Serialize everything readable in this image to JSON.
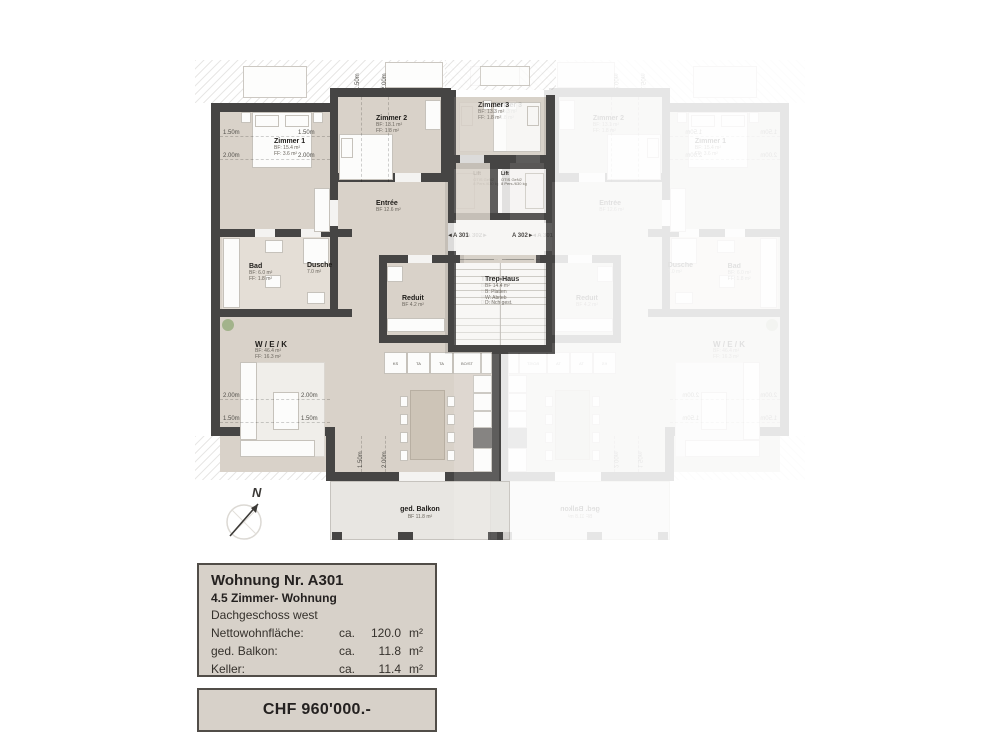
{
  "plan": {
    "compass_label": "N",
    "dims": {
      "d150": "1.50m",
      "d200": "2.00m"
    },
    "unit_markers": {
      "a301": "◄A 301",
      "a302": "A 302►"
    },
    "rooms": {
      "zimmer1": {
        "name": "Zimmer 1",
        "l1": "BF: 15.4 m²",
        "l2": "FF: 3.6 m²"
      },
      "zimmer2": {
        "name": "Zimmer 2",
        "l1": "BF: 13.1 m²",
        "l2": "FF: 1.8 m²"
      },
      "zimmer3": {
        "name": "Zimmer 3",
        "l1": "BF: 13.3 m²",
        "l2": "FF: 1.8 m²"
      },
      "entree": {
        "name": "Entrée",
        "l1": "BF 12.6 m²"
      },
      "bad": {
        "name": "Bad",
        "l1": "BF: 6.0 m²",
        "l2": "FF: 1.8 m²"
      },
      "dusche": {
        "name": "Dusche",
        "l1": "7.0 m²"
      },
      "reduit": {
        "name": "Reduit",
        "l1": "BF 4.2 m²"
      },
      "trephaus": {
        "name": "Trep-Haus",
        "l1": "BF 14.4 m²",
        "l2": "B: Platten",
        "l3": "W: Abrieb",
        "l4": "D: Nch gest."
      },
      "lift": {
        "name": "Lift",
        "l1": "OTIS GeN2",
        "l2": "8 Pers./630 kg"
      },
      "wek": {
        "name": "W / E / K",
        "l1": "BF: 46.4 m²",
        "l2": "FF: 16.3 m²"
      },
      "balkon": {
        "name": "ged. Balkon",
        "l1": "BF 11.8 m²"
      }
    },
    "kitchen_labels": [
      "KS",
      "TA",
      "TA",
      "BO/ST"
    ]
  },
  "info_box": {
    "title": "Wohnung Nr. A301",
    "subtitle": "4.5 Zimmer- Wohnung",
    "floor": "Dachgeschoss west",
    "rows": [
      {
        "label": "Nettowohnfläche:",
        "ca": "ca.",
        "value": "120.0",
        "unit": "m²"
      },
      {
        "label": "ged. Balkon:",
        "ca": "ca.",
        "value": "11.8",
        "unit": "m²"
      },
      {
        "label": "Keller:",
        "ca": "ca.",
        "value": "11.4",
        "unit": "m²"
      }
    ]
  },
  "price_box": {
    "price": "CHF 960'000.-"
  }
}
